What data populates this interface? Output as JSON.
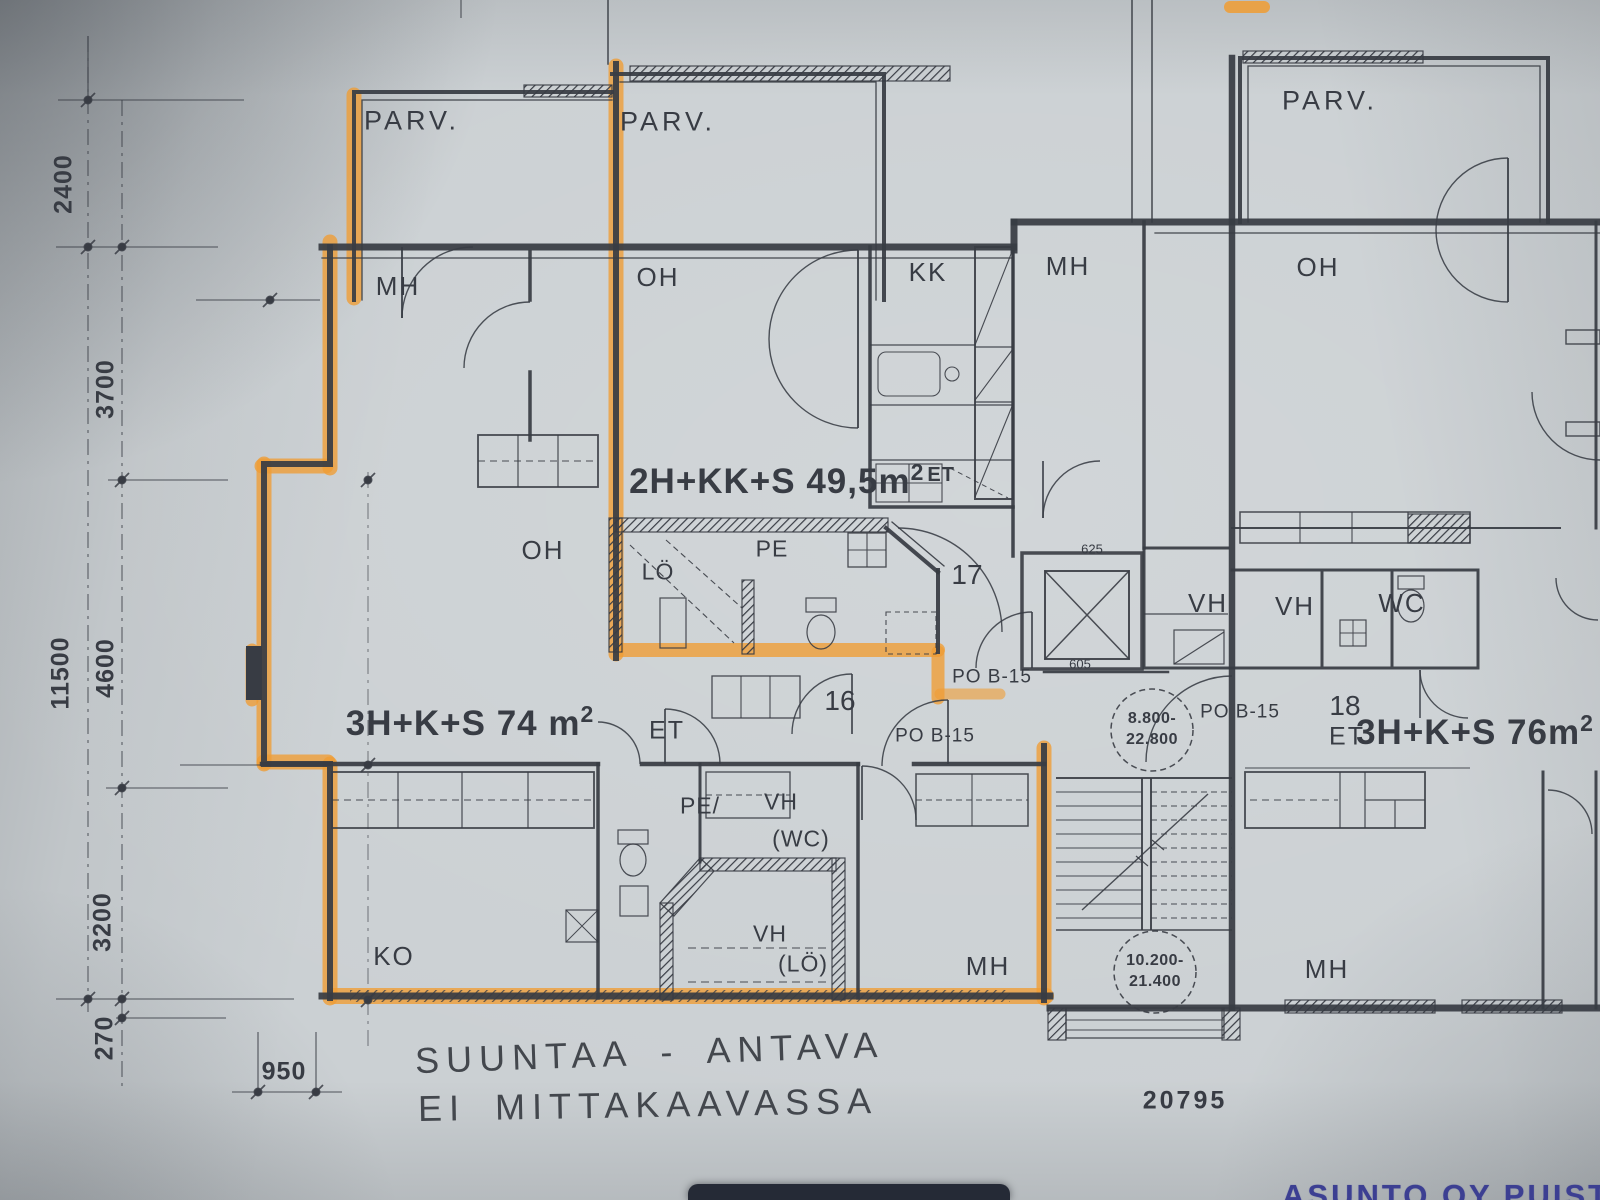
{
  "colors": {
    "paper": "#cbd0d3",
    "ink": "#383c44",
    "highlighter": "#f09c33",
    "stamp_blue": "#3c3f92"
  },
  "balconies": {
    "left": "PARV.",
    "middle": "PARV.",
    "right": "PARV."
  },
  "rooms": {
    "mh_top_left": "MH",
    "oh_top_left": "OH",
    "kk": "KK",
    "mh_top_mid": "MH",
    "oh_top_right": "OH",
    "oh_left": "OH",
    "lo": "LÖ",
    "pe": "PE",
    "vh_mid": "VH",
    "vh_right": "VH",
    "wc": "WC",
    "pe_lower": "PE/",
    "vh_wc": "VH",
    "vh_wc_sub": "(WC)",
    "vh_lo": "VH",
    "vh_lo_sub": "(LÖ)",
    "ko": "KO",
    "mh_lower_mid": "MH",
    "mh_lower_right": "MH"
  },
  "apartments": {
    "apt17": {
      "label": "2H+KK+S 49,5m",
      "sup": "2",
      "suffix": "ET",
      "number": "17"
    },
    "apt16": {
      "label": "3H+K+S  74 m",
      "sup": "2",
      "entry": "ET",
      "number": "16"
    },
    "apt18": {
      "entry": "ET",
      "label": "3H+K+S 76m",
      "sup": "2",
      "number": "18"
    }
  },
  "door_ratings": {
    "first": "PO B-15",
    "second": "PO B-15",
    "third": "PO B-15"
  },
  "level_markers": {
    "upper": [
      "8.800-",
      "22.800"
    ],
    "lower": [
      "10.200-",
      "21.400"
    ]
  },
  "dimensions": {
    "v2400": "2400",
    "v3700": "3700",
    "v11500": "11500",
    "v4600": "4600",
    "v3200": "3200",
    "v270": "270",
    "h950": "950",
    "small_top": "625",
    "small_bottom": "605",
    "plan_number": "20795"
  },
  "notes": {
    "line1": "SUUNTAA - ANTAVA",
    "line2": "EI MITTAKAAVASSA"
  },
  "stamp": {
    "text": "ASUNTO OY PUISTO"
  }
}
